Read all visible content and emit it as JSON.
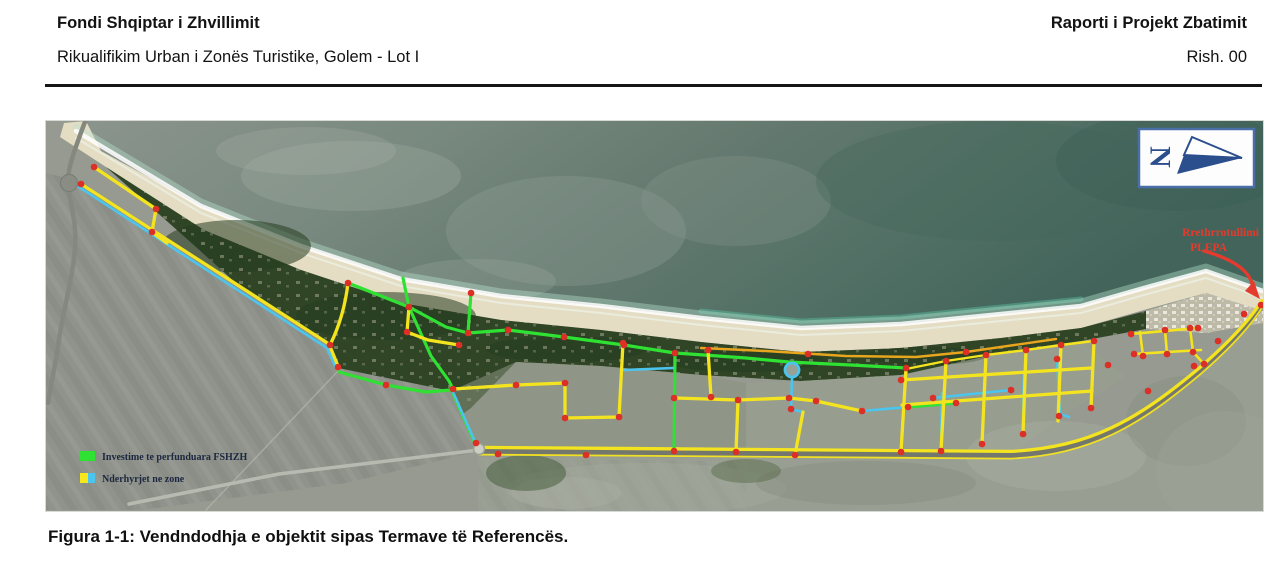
{
  "header": {
    "org_title": "Fondi Shqiptar i Zhvillimit",
    "report_title": "Raporti i Projekt Zbatimit",
    "project_subtitle": "Rikualifikim Urban i Zonës Turistike, Golem - Lot I",
    "revision": "Rish. 00"
  },
  "map": {
    "north_label": "N",
    "annotation": {
      "line1": "Rrethrrotullimi",
      "line2": "PLEPA"
    },
    "legend": {
      "items": [
        {
          "label": "Investime te perfunduara FSHZH",
          "color": "#2fe132"
        },
        {
          "label": "Nderhyrjet ne zone",
          "color_a": "#f6e71e",
          "color_b": "#4cc5ee"
        }
      ]
    },
    "palette": {
      "investment_green": "#2fe132",
      "intervention_yellow": "#f3e41f",
      "intervention_cyan": "#4cc5ee",
      "node_red": "#dc2f26",
      "annotation_red": "#e33b2e",
      "north_blue": "#2b4e8d",
      "coastal_orange": "#e8a51e"
    }
  },
  "figure": {
    "caption": "Figura 1-1: Vendndodhja e objektit sipas Termave të Referencës."
  }
}
